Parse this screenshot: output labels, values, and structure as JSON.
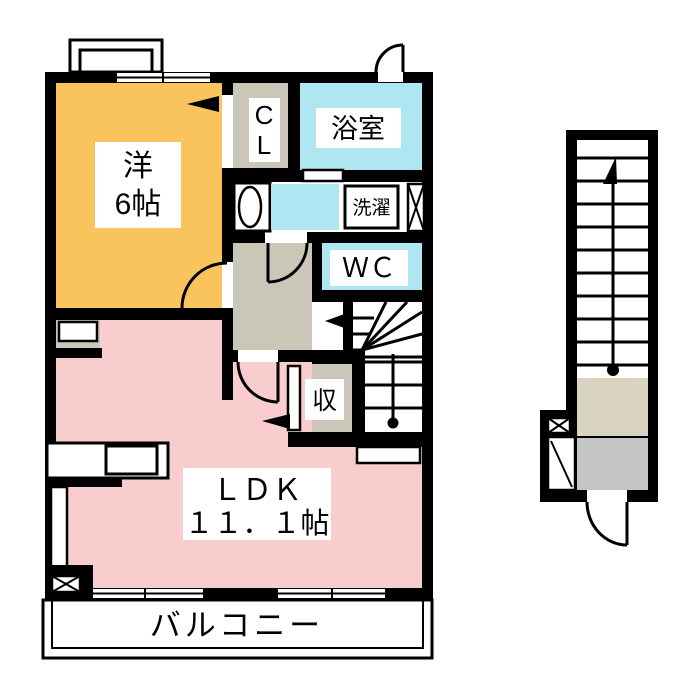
{
  "plan": {
    "labels": {
      "western_room_line1": "洋",
      "western_room_line2": "6帖",
      "closet_line1": "C",
      "closet_line2": "L",
      "bathroom": "浴室",
      "laundry": "洗濯",
      "wc": "ＷＣ",
      "storage": "収",
      "ldk_line1": "ＬＤＫ",
      "ldk_line2": "１１．１帖",
      "balcony": "バルコニー"
    },
    "colors": {
      "wall": "#000000",
      "western_room": "#f9c45c",
      "water_room": "#aee7f2",
      "ldk": "#f9cdcd",
      "hall": "#cbc7b8",
      "landing": "#d9d4c2",
      "porch": "#c5c5c5"
    }
  }
}
